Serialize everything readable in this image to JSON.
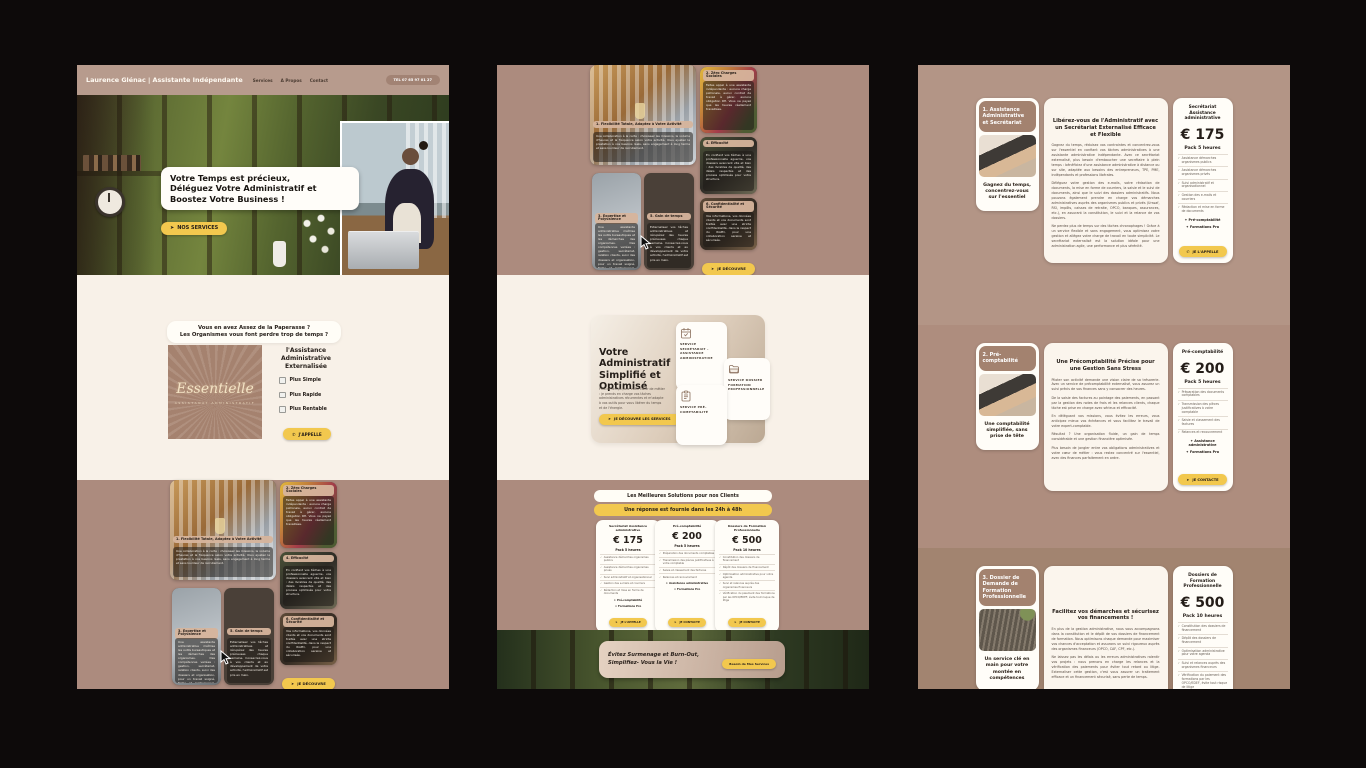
{
  "header": {
    "brand": "Laurence Glénac | Assistante Indépendante",
    "nav": [
      "Services",
      "A Propos",
      "Contact"
    ],
    "phone": "TEL 07 65 97 01 27"
  },
  "hero": {
    "title": "Votre Temps est précieux,\nDéléguez Votre Administratif et\nBoostez Votre Business !",
    "cta": "NOS SERVICES"
  },
  "intro": {
    "question": "Vous en avez Assez de la Paperasse ?\nLes Organismes vous font perdre trop de temps ?",
    "logo_name": "Essentielle",
    "logo_tagline": "ASSISTANAT ADMINISTRATIF",
    "title": "l'Assistance\nAdministrative\nExternalisée",
    "points": [
      "Plus Simple",
      "Plus Rapide",
      "Plus Rentable"
    ],
    "cta": "J'APPELLE"
  },
  "benefits": {
    "cta": "JE DÉCOUVRE",
    "cards": [
      {
        "title": "1. Flexibilité Totale, Adaptez à Votre Activité",
        "text": "Une collaboration à la carte : choisissez les missions, le volume d'heures et la fréquence selon votre activité. Vous ajustez la prestation à vos besoins réels, sans engagement à long terme et sans lourdeur de recrutement."
      },
      {
        "title": "2. Zéro Charges Sociales",
        "text": "Faites appel à une assistante indépendante : aucune charge patronale, aucun contrat de travail à gérer, aucune obligation RH. Vous ne payez que les heures réellement travaillées."
      },
      {
        "title": "3. Expertise et Polyvalence",
        "text": "Une assistante administrative maîtrise les outils bureautiques et les démarches des organismes. Des compétences variées : gestion, secrétariat, relation clients, suivi des dossiers et organisation, pour un travail soigné, fiable et professionnel, au service de votre entreprise et de sa croissance."
      },
      {
        "title": "4. Efficacité",
        "text": "En confiant vos tâches à une professionnelle aguerrie, vos dossiers avancent vite et bien : des livrables de qualité, des délais respectés et des process optimisés pour votre structure."
      },
      {
        "title": "5. Gain de temps",
        "text": "Externalisez vos tâches administratives et récupérez des heures précieuses chaque semaine. Consacrez-vous à vos clients et au développement de votre activité, l'administratif est pris en main."
      },
      {
        "title": "6. Confidentialité et Sécurité",
        "text": "Vos informations, vos données clients et vos documents sont traités avec une stricte confidentialité, dans le respect du RGPD, pour une collaboration sereine et sécurisée."
      }
    ]
  },
  "services": {
    "heading": "Votre Administratif Simplifié et Optimisé",
    "intro": "Plus de temps pour votre cœur de métier : je prends en charge vos tâches administratives récurrentes et m'adapte à vos outils pour vous libérer du temps et de l'énergie.",
    "cta": "JE DÉCOUVRE LES SERVICES",
    "cards": [
      {
        "label": "SERVICE SECRÉTARIAT - ASSISTANCE ADMINISTRATIVE"
      },
      {
        "label": "SERVICE DOSSIER FORMATION PROFESSIONNELLE"
      },
      {
        "label": "SERVICE PRÉ-COMPTABILITÉ"
      }
    ]
  },
  "solutions": {
    "heading": "Les Meilleures Solutions pour nos Clients",
    "banner": "Une réponse est fournie dans les 24h à 48h"
  },
  "pricing": [
    {
      "name": "Secrétariat Assistance administrative",
      "price": "€ 175",
      "pack": "Pack 5 heures",
      "features": [
        "Assistance démarches organismes publics",
        "Assistance démarches organismes privés",
        "Suivi administratif et organisationnel",
        "Gestion des e-mails et courriers",
        "Rédaction et mise en forme de documents"
      ],
      "extras": [
        "Pré-comptabilité",
        "Formations Pro"
      ],
      "cta": "JE L'APPELLE"
    },
    {
      "name": "Pré-comptabilité",
      "price": "€ 200",
      "pack": "Pack 5 heures",
      "features": [
        "Préparation des documents comptables",
        "Transmission des pièces justificatives à votre comptable",
        "Saisie et classement des factures",
        "Relances et recouvrement"
      ],
      "extras": [
        "Assistance administrative",
        "Formations Pro"
      ],
      "cta": "JE CONTACTE"
    },
    {
      "name": "Dossiers de Formation Professionnelle",
      "price": "€ 500",
      "pack": "Pack 10 heures",
      "features": [
        "Constitution des dossiers de financement",
        "Dépôt des dossiers de financement",
        "Optimisation administrative pour votre agenda",
        "Suivi et relances auprès des organismes financeurs",
        "Vérification du paiement des formations par les OPCO/EDEF, évite tout risque de litige"
      ],
      "extras": [],
      "cta": "JE CONTACTE"
    }
  ],
  "footer": {
    "text": "Évitez Surmenage et Burn-Out,\nSimplifiez- Vous la Vie !",
    "cta": "Besoin de Mes Services"
  },
  "details": [
    {
      "badge": "1. Assistance Administrative et Secrétariat",
      "caption": "Gagnez du temps, concentrez-vous sur l'essentiel",
      "title": "Libérez-vous de l'Administratif avec un Secrétariat Externalisé Efficace et Flexible",
      "paragraphs": [
        "Gagnez du temps, réduisez vos contraintes et concentrez-vous sur l'essentiel en confiant vos tâches administratives à une assistante administrative indépendante. Avec ce secrétariat externalisé, plus besoin d'embaucher une secrétaire à plein temps : bénéficiez d'une assistance administrative à distance ou sur site, adaptée aux besoins des entrepreneurs, TPE, PME, indépendants et professions libérales.",
        "Déléguez votre gestion des e-mails, votre rédaction de documents, la mise en forme de courriers, la saisie et le suivi de documents, ainsi que le suivi des dossiers administratifs. Nous pouvons également prendre en charge vos démarches administratives auprès des organismes publics et privés (Urssaf, RSI, impôts, caisses de retraite, OPCO, banques, assurances, etc.), en assurant la constitution, le suivi et la relance de vos dossiers.",
        "Ne perdez plus de temps sur des tâches chronophages ! Grâce à un service flexible et sans engagement, vous optimisez votre gestion et allégez votre charge de travail en toute simplicité. Le secrétariat externalisé est la solution idéale pour une administration agile, une performance et plus sérénité."
      ]
    },
    {
      "badge": "2. Pré-comptabilité",
      "caption": "Une comptabilité simplifiée, sans prise de tête",
      "title": "Une Précomptabilité Précise pour une Gestion Sans Stress",
      "paragraphs": [
        "Piloter son activité demande une vision claire de sa trésorerie. Avec un service de précomptabilité externalisé, vous assurez un suivi précis de vos finances sans y consacrer des heures.",
        "De la saisie des factures au pointage des paiements, en passant par la gestion des notes de frais et les relances clients, chaque tâche est prise en charge avec sérieux et efficacité.",
        "En déléguant vos missions, vous évitez les erreurs, vous anticipez mieux vos échéances et vous facilitez le travail de votre expert-comptable.",
        "Résultat ? Une organisation fluide, un gain de temps considérable et une gestion financière optimisée.",
        "Plus besoin de jongler entre vos obligations administratives et votre cœur de métier : vous restez concentré sur l'essentiel, avec des finances parfaitement en ordre."
      ]
    },
    {
      "badge": "3. Dossier de Demande de Formation Professionnelle",
      "caption": "Un service clé en main pour votre montée en compétences",
      "title": "Facilitez vos démarches et sécurisez vos financements !",
      "paragraphs": [
        "En plus de la gestion administrative, nous vous accompagnons dans la constitution et le dépôt de vos dossiers de financement de formation. Nous optimisons chaque demande pour maximiser vos chances d'acceptation et assurons un suivi rigoureux auprès des organismes financeurs (OPCO, CAF, CPF, etc.).",
        "Ne laissez pas les délais ou les erreurs administratives ralentir vos projets : nous prenons en charge les relances et la vérification des paiements pour éviter tout retard ou litige. Externaliser cette gestion, c'est vous assurer un traitement efficace et un financement sécurisé, sans perte de temps."
      ]
    }
  ]
}
